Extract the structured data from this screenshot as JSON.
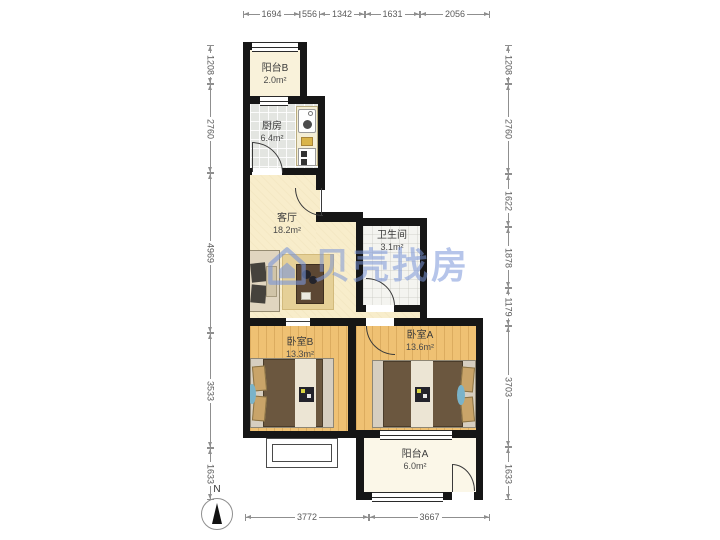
{
  "watermark": {
    "text": "贝壳找房",
    "color": "#7a96d8",
    "logo": "beike-house-logo"
  },
  "compass": {
    "label": "N"
  },
  "rooms": [
    {
      "id": "balcony-b",
      "name": "阳台B",
      "area": "2.0m²"
    },
    {
      "id": "kitchen",
      "name": "厨房",
      "area": "6.4m²"
    },
    {
      "id": "living",
      "name": "客厅",
      "area": "18.2m²"
    },
    {
      "id": "bathroom",
      "name": "卫生间",
      "area": "3.1m²"
    },
    {
      "id": "bedroom-b",
      "name": "卧室B",
      "area": "13.3m²"
    },
    {
      "id": "bedroom-a",
      "name": "卧室A",
      "area": "13.6m²"
    },
    {
      "id": "balcony-a",
      "name": "阳台A",
      "area": "6.0m²"
    }
  ],
  "dimensions": {
    "top": [
      "1694",
      "556",
      "1342",
      "1631",
      "2056"
    ],
    "bottom": [
      "3772",
      "3667"
    ],
    "left": [
      "1208",
      "2760",
      "4969",
      "3533",
      "1633"
    ],
    "right": [
      "1208",
      "2760",
      "1622",
      "1878",
      "1179",
      "3703",
      "1633"
    ]
  },
  "colors": {
    "wall": "#161616",
    "living_floor": "#f8edcb",
    "bedroom_floor": "#efc173",
    "kitchen_floor": "#e3e5e1",
    "watermark_blue": "#7a96d8"
  }
}
